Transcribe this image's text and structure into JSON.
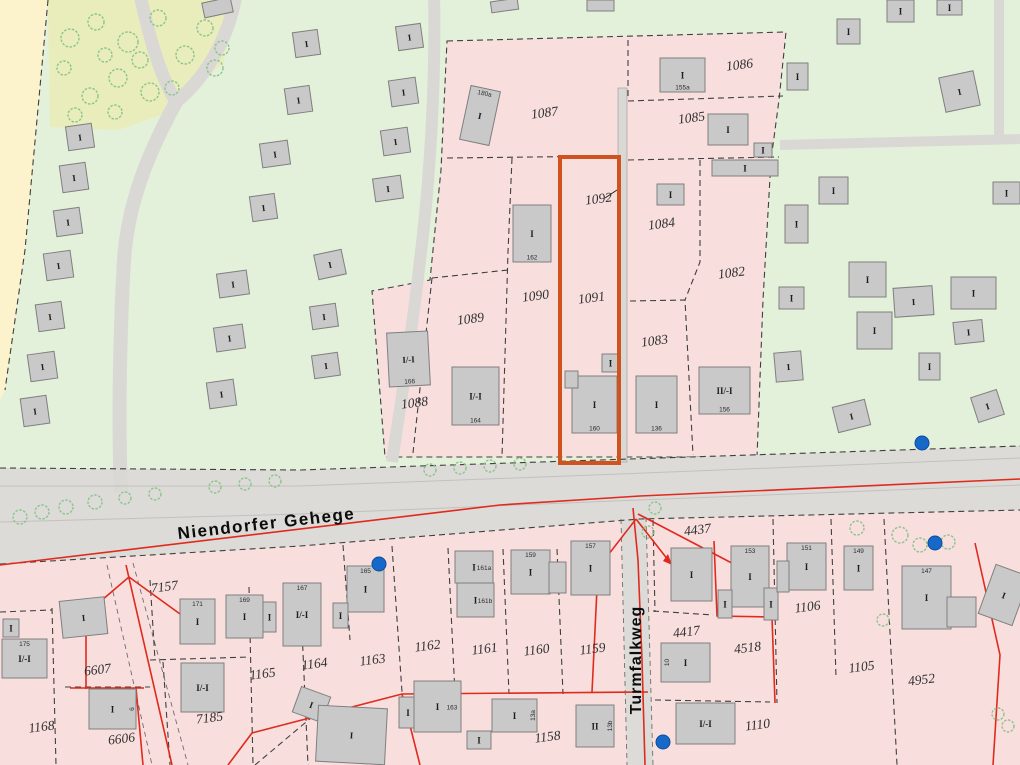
{
  "map_title": "Liegenschaftskarte (cadastral map)",
  "streets": [
    {
      "name": "Niendorfer Gehege"
    },
    {
      "name": "Turmfalkweg"
    }
  ],
  "highlight": {
    "x": 560,
    "y": 157,
    "w": 59,
    "h": 306,
    "note": "orange selected parcel outline",
    "color": "#d0531f"
  },
  "colors": {
    "parcel_pink": "#f8dfde",
    "forest_green": "#e3f0da",
    "meadow_olive": "#e9edbc",
    "field_yellow": "#fcf3cc",
    "street_gray": "#dcdbd7",
    "building_gray": "#c9c9c9",
    "boundary_red": "#e02a1e",
    "highlight_orange": "#d0531f",
    "marker_blue": "#1668c9"
  },
  "map": {
    "parcels": [
      {
        "label": "1087",
        "x": 545,
        "y": 117
      },
      {
        "label": "1086",
        "x": 740,
        "y": 69
      },
      {
        "label": "1085",
        "x": 692,
        "y": 122
      },
      {
        "label": "1084",
        "x": 662,
        "y": 228
      },
      {
        "label": "1082",
        "x": 732,
        "y": 277
      },
      {
        "label": "1083",
        "x": 655,
        "y": 345
      },
      {
        "label": "1092",
        "x": 599,
        "y": 203
      },
      {
        "label": "1091",
        "x": 592,
        "y": 302
      },
      {
        "label": "1090",
        "x": 536,
        "y": 300
      },
      {
        "label": "1089",
        "x": 471,
        "y": 323
      },
      {
        "label": "1088",
        "x": 415,
        "y": 407
      },
      {
        "label": "7157",
        "x": 165,
        "y": 591
      },
      {
        "label": "6607",
        "x": 98,
        "y": 674
      },
      {
        "label": "6606",
        "x": 122,
        "y": 743
      },
      {
        "label": "1168",
        "x": 42,
        "y": 731
      },
      {
        "label": "7185",
        "x": 210,
        "y": 722
      },
      {
        "label": "1165",
        "x": 263,
        "y": 678
      },
      {
        "label": "1164",
        "x": 315,
        "y": 668
      },
      {
        "label": "1163",
        "x": 373,
        "y": 664
      },
      {
        "label": "1162",
        "x": 428,
        "y": 650
      },
      {
        "label": "1161",
        "x": 485,
        "y": 653
      },
      {
        "label": "1160",
        "x": 537,
        "y": 654
      },
      {
        "label": "1159",
        "x": 593,
        "y": 653
      },
      {
        "label": "1158",
        "x": 548,
        "y": 741
      },
      {
        "label": "4437",
        "x": 698,
        "y": 534
      },
      {
        "label": "4417",
        "x": 687,
        "y": 636
      },
      {
        "label": "4518",
        "x": 748,
        "y": 652
      },
      {
        "label": "1106",
        "x": 808,
        "y": 611
      },
      {
        "label": "1105",
        "x": 862,
        "y": 671
      },
      {
        "label": "4952",
        "x": 922,
        "y": 684
      },
      {
        "label": "1110",
        "x": 758,
        "y": 729
      }
    ],
    "buildings": [
      {
        "x": 465,
        "y": 88,
        "w": 30,
        "h": 55,
        "r": 12,
        "l": "I",
        "n": "180a",
        "np": "t"
      },
      {
        "x": 513,
        "y": 205,
        "w": 38,
        "h": 57,
        "r": 0,
        "l": "I",
        "n": "162",
        "np": "b"
      },
      {
        "x": 452,
        "y": 367,
        "w": 47,
        "h": 58,
        "r": 0,
        "l": "I/-I",
        "n": "164",
        "np": "b"
      },
      {
        "x": 388,
        "y": 332,
        "w": 41,
        "h": 54,
        "r": -3,
        "l": "I/-I",
        "n": "166",
        "np": "b"
      },
      {
        "x": 660,
        "y": 58,
        "w": 45,
        "h": 34,
        "r": 0,
        "l": "I",
        "n": "155a",
        "np": "b"
      },
      {
        "x": 708,
        "y": 114,
        "w": 40,
        "h": 31,
        "r": 0,
        "l": "I"
      },
      {
        "x": 754,
        "y": 143,
        "w": 18,
        "h": 14,
        "r": 0,
        "l": "I"
      },
      {
        "x": 712,
        "y": 160,
        "w": 66,
        "h": 16,
        "r": 0,
        "l": "I"
      },
      {
        "x": 657,
        "y": 184,
        "w": 27,
        "h": 21,
        "r": 0,
        "l": "I"
      },
      {
        "x": 572,
        "y": 376,
        "w": 45,
        "h": 57,
        "r": 0,
        "l": "I",
        "n": "160",
        "np": "b"
      },
      {
        "x": 565,
        "y": 371,
        "w": 13,
        "h": 17,
        "r": 0,
        "l": ""
      },
      {
        "x": 602,
        "y": 354,
        "w": 17,
        "h": 18,
        "r": 0,
        "l": "I"
      },
      {
        "x": 636,
        "y": 376,
        "w": 41,
        "h": 57,
        "r": 0,
        "l": "I",
        "n": "136",
        "np": "b"
      },
      {
        "x": 699,
        "y": 367,
        "w": 51,
        "h": 47,
        "r": 0,
        "l": "II/-I",
        "n": "156",
        "np": "b"
      },
      {
        "x": 819,
        "y": 177,
        "w": 29,
        "h": 27,
        "r": 0,
        "l": "I"
      },
      {
        "x": 785,
        "y": 205,
        "w": 23,
        "h": 38,
        "r": 0,
        "l": "I"
      },
      {
        "x": 993,
        "y": 182,
        "w": 27,
        "h": 22,
        "r": 0,
        "l": "I"
      },
      {
        "x": 779,
        "y": 287,
        "w": 25,
        "h": 22,
        "r": 0,
        "l": "I"
      },
      {
        "x": 849,
        "y": 262,
        "w": 37,
        "h": 35,
        "r": 0,
        "l": "I"
      },
      {
        "x": 894,
        "y": 287,
        "w": 39,
        "h": 29,
        "r": -4,
        "l": "I"
      },
      {
        "x": 951,
        "y": 277,
        "w": 45,
        "h": 32,
        "r": 0,
        "l": "I"
      },
      {
        "x": 857,
        "y": 312,
        "w": 35,
        "h": 37,
        "r": 0,
        "l": "I"
      },
      {
        "x": 954,
        "y": 321,
        "w": 29,
        "h": 22,
        "r": -6,
        "l": "I"
      },
      {
        "x": 919,
        "y": 353,
        "w": 21,
        "h": 27,
        "r": 0,
        "l": "I"
      },
      {
        "x": 775,
        "y": 352,
        "w": 27,
        "h": 29,
        "r": -5,
        "l": "I"
      },
      {
        "x": 835,
        "y": 403,
        "w": 33,
        "h": 26,
        "r": -14,
        "l": "I"
      },
      {
        "x": 974,
        "y": 393,
        "w": 27,
        "h": 26,
        "r": -18,
        "l": "I"
      },
      {
        "x": 837,
        "y": 19,
        "w": 23,
        "h": 25,
        "r": 0,
        "l": "I"
      },
      {
        "x": 887,
        "y": 0,
        "w": 27,
        "h": 22,
        "r": 0,
        "l": "I"
      },
      {
        "x": 937,
        "y": 0,
        "w": 25,
        "h": 15,
        "r": 0,
        "l": "I"
      },
      {
        "x": 787,
        "y": 63,
        "w": 21,
        "h": 27,
        "r": 0,
        "l": "I"
      },
      {
        "x": 942,
        "y": 74,
        "w": 35,
        "h": 35,
        "r": -12,
        "l": "I"
      },
      {
        "x": 67,
        "y": 125,
        "w": 26,
        "h": 24,
        "r": -8,
        "l": "I"
      },
      {
        "x": 61,
        "y": 164,
        "w": 26,
        "h": 27,
        "r": -8,
        "l": "I"
      },
      {
        "x": 55,
        "y": 209,
        "w": 26,
        "h": 26,
        "r": -8,
        "l": "I"
      },
      {
        "x": 45,
        "y": 252,
        "w": 27,
        "h": 27,
        "r": -8,
        "l": "I"
      },
      {
        "x": 37,
        "y": 303,
        "w": 26,
        "h": 27,
        "r": -8,
        "l": "I"
      },
      {
        "x": 29,
        "y": 353,
        "w": 27,
        "h": 27,
        "r": -8,
        "l": "I"
      },
      {
        "x": 22,
        "y": 397,
        "w": 26,
        "h": 28,
        "r": -8,
        "l": "I"
      },
      {
        "x": 294,
        "y": 31,
        "w": 25,
        "h": 25,
        "r": -8,
        "l": "I"
      },
      {
        "x": 286,
        "y": 87,
        "w": 25,
        "h": 26,
        "r": -8,
        "l": "I"
      },
      {
        "x": 261,
        "y": 142,
        "w": 28,
        "h": 24,
        "r": -8,
        "l": "I"
      },
      {
        "x": 251,
        "y": 195,
        "w": 25,
        "h": 25,
        "r": -8,
        "l": "I"
      },
      {
        "x": 218,
        "y": 272,
        "w": 30,
        "h": 24,
        "r": -8,
        "l": "I"
      },
      {
        "x": 215,
        "y": 326,
        "w": 29,
        "h": 24,
        "r": -8,
        "l": "I"
      },
      {
        "x": 208,
        "y": 381,
        "w": 27,
        "h": 26,
        "r": -8,
        "l": "I"
      },
      {
        "x": 397,
        "y": 25,
        "w": 25,
        "h": 24,
        "r": -8,
        "l": "I"
      },
      {
        "x": 390,
        "y": 79,
        "w": 27,
        "h": 26,
        "r": -8,
        "l": "I"
      },
      {
        "x": 382,
        "y": 129,
        "w": 27,
        "h": 25,
        "r": -8,
        "l": "I"
      },
      {
        "x": 374,
        "y": 177,
        "w": 28,
        "h": 23,
        "r": -8,
        "l": "I"
      },
      {
        "x": 316,
        "y": 252,
        "w": 28,
        "h": 25,
        "r": -12,
        "l": "I"
      },
      {
        "x": 311,
        "y": 305,
        "w": 26,
        "h": 23,
        "r": -8,
        "l": "I"
      },
      {
        "x": 313,
        "y": 354,
        "w": 26,
        "h": 23,
        "r": -8,
        "l": "I"
      },
      {
        "x": 203,
        "y": 0,
        "w": 29,
        "h": 15,
        "r": -12,
        "l": ""
      },
      {
        "x": 491,
        "y": 0,
        "w": 27,
        "h": 11,
        "r": -8,
        "l": ""
      },
      {
        "x": 587,
        "y": 0,
        "w": 27,
        "h": 11,
        "r": 0,
        "l": ""
      },
      {
        "x": 2,
        "y": 639,
        "w": 45,
        "h": 39,
        "r": 0,
        "l": "I/-I",
        "n": "175",
        "np": "t"
      },
      {
        "x": 3,
        "y": 619,
        "w": 16,
        "h": 18,
        "r": 0,
        "l": "I"
      },
      {
        "x": 61,
        "y": 599,
        "w": 45,
        "h": 37,
        "r": -6,
        "l": "I"
      },
      {
        "x": 180,
        "y": 599,
        "w": 35,
        "h": 45,
        "r": 0,
        "l": "I",
        "n": "171",
        "np": "t"
      },
      {
        "x": 226,
        "y": 595,
        "w": 37,
        "h": 43,
        "r": 0,
        "l": "I",
        "n": "169",
        "np": "t"
      },
      {
        "x": 263,
        "y": 602,
        "w": 13,
        "h": 30,
        "r": 0,
        "l": "I"
      },
      {
        "x": 283,
        "y": 583,
        "w": 38,
        "h": 63,
        "r": 0,
        "l": "I/-I",
        "n": "167",
        "np": "t"
      },
      {
        "x": 347,
        "y": 566,
        "w": 37,
        "h": 46,
        "r": 0,
        "l": "I",
        "n": "165",
        "np": "t"
      },
      {
        "x": 333,
        "y": 603,
        "w": 15,
        "h": 25,
        "r": 0,
        "l": "I"
      },
      {
        "x": 455,
        "y": 551,
        "w": 38,
        "h": 32,
        "r": 0,
        "l": "I",
        "n": "161a",
        "np": "r"
      },
      {
        "x": 457,
        "y": 583,
        "w": 37,
        "h": 34,
        "r": 0,
        "l": "I",
        "n": "161b",
        "np": "r"
      },
      {
        "x": 511,
        "y": 550,
        "w": 39,
        "h": 44,
        "r": 0,
        "l": "I",
        "n": "159",
        "np": "t"
      },
      {
        "x": 549,
        "y": 562,
        "w": 17,
        "h": 31,
        "r": 0,
        "l": ""
      },
      {
        "x": 571,
        "y": 541,
        "w": 39,
        "h": 54,
        "r": 0,
        "l": "I",
        "n": "157",
        "np": "t"
      },
      {
        "x": 296,
        "y": 691,
        "w": 31,
        "h": 27,
        "r": 20,
        "l": "I"
      },
      {
        "x": 317,
        "y": 707,
        "w": 69,
        "h": 56,
        "r": 3,
        "l": "I"
      },
      {
        "x": 399,
        "y": 697,
        "w": 18,
        "h": 31,
        "r": 0,
        "l": "I"
      },
      {
        "x": 414,
        "y": 681,
        "w": 47,
        "h": 51,
        "r": 0,
        "l": "I",
        "n": "163",
        "np": "r"
      },
      {
        "x": 467,
        "y": 731,
        "w": 24,
        "h": 18,
        "r": 0,
        "l": "I"
      },
      {
        "x": 492,
        "y": 699,
        "w": 45,
        "h": 33,
        "r": 0,
        "l": "I",
        "n": "13a",
        "np": "rv"
      },
      {
        "x": 576,
        "y": 705,
        "w": 38,
        "h": 42,
        "r": 0,
        "l": "II",
        "n": "13b",
        "np": "rv"
      },
      {
        "x": 671,
        "y": 548,
        "w": 41,
        "h": 53,
        "r": 0,
        "l": "I"
      },
      {
        "x": 731,
        "y": 546,
        "w": 38,
        "h": 61,
        "r": 0,
        "l": "I",
        "n": "153",
        "np": "t"
      },
      {
        "x": 718,
        "y": 590,
        "w": 14,
        "h": 28,
        "r": 0,
        "l": "I"
      },
      {
        "x": 764,
        "y": 588,
        "w": 14,
        "h": 32,
        "r": 0,
        "l": "I"
      },
      {
        "x": 787,
        "y": 543,
        "w": 39,
        "h": 47,
        "r": 0,
        "l": "I",
        "n": "151",
        "np": "t"
      },
      {
        "x": 777,
        "y": 561,
        "w": 12,
        "h": 31,
        "r": 0,
        "l": ""
      },
      {
        "x": 844,
        "y": 546,
        "w": 29,
        "h": 44,
        "r": 0,
        "l": "I",
        "n": "149",
        "np": "t"
      },
      {
        "x": 902,
        "y": 566,
        "w": 49,
        "h": 63,
        "r": 0,
        "l": "I",
        "n": "147",
        "np": "t"
      },
      {
        "x": 947,
        "y": 597,
        "w": 29,
        "h": 30,
        "r": 0,
        "l": ""
      },
      {
        "x": 986,
        "y": 569,
        "w": 36,
        "h": 52,
        "r": 20,
        "l": "I"
      },
      {
        "x": 661,
        "y": 643,
        "w": 49,
        "h": 39,
        "r": 0,
        "l": "I",
        "n": "10",
        "np": "lv"
      },
      {
        "x": 676,
        "y": 703,
        "w": 59,
        "h": 41,
        "r": 0,
        "l": "I/-I"
      },
      {
        "x": 89,
        "y": 689,
        "w": 47,
        "h": 40,
        "r": 0,
        "l": "I",
        "n": "6",
        "np": "rv"
      },
      {
        "x": 181,
        "y": 663,
        "w": 43,
        "h": 49,
        "r": 0,
        "l": "I/-I"
      }
    ],
    "markers": [
      {
        "x": 379,
        "y": 564
      },
      {
        "x": 935,
        "y": 543
      },
      {
        "x": 922,
        "y": 443
      },
      {
        "x": 663,
        "y": 742
      }
    ],
    "trees": [
      [
        70,
        38,
        9
      ],
      [
        96,
        22,
        8
      ],
      [
        128,
        42,
        10
      ],
      [
        158,
        18,
        8
      ],
      [
        185,
        55,
        9
      ],
      [
        118,
        78,
        9
      ],
      [
        90,
        96,
        8
      ],
      [
        150,
        92,
        9
      ],
      [
        205,
        28,
        8
      ],
      [
        215,
        68,
        8
      ],
      [
        64,
        68,
        7
      ],
      [
        172,
        88,
        7
      ],
      [
        140,
        60,
        8
      ],
      [
        105,
        55,
        7
      ],
      [
        222,
        48,
        7
      ],
      [
        75,
        115,
        7
      ],
      [
        115,
        112,
        7
      ],
      [
        20,
        517,
        7
      ],
      [
        42,
        512,
        7
      ],
      [
        66,
        507,
        7
      ],
      [
        95,
        502,
        7
      ],
      [
        125,
        498,
        6
      ],
      [
        155,
        494,
        6
      ],
      [
        215,
        487,
        6
      ],
      [
        245,
        484,
        6
      ],
      [
        275,
        481,
        6
      ],
      [
        430,
        470,
        6
      ],
      [
        460,
        468,
        6
      ],
      [
        490,
        466,
        6
      ],
      [
        520,
        464,
        6
      ],
      [
        655,
        508,
        6
      ],
      [
        648,
        532,
        6
      ],
      [
        857,
        528,
        7
      ],
      [
        900,
        535,
        8
      ],
      [
        920,
        545,
        7
      ],
      [
        948,
        542,
        7
      ],
      [
        883,
        620,
        6
      ],
      [
        998,
        714,
        6
      ],
      [
        1008,
        726,
        6
      ]
    ]
  }
}
